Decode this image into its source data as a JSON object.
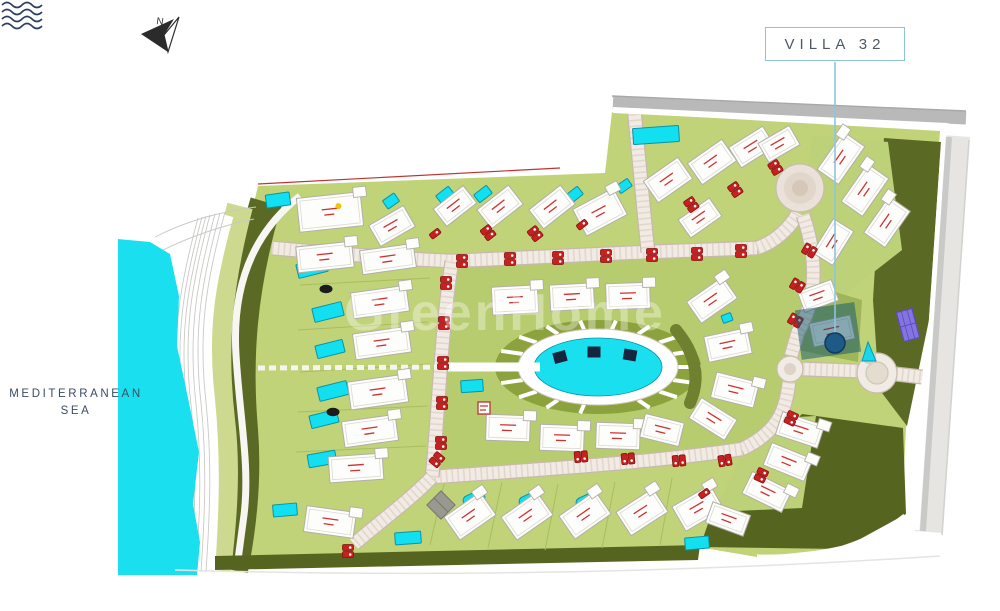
{
  "compass": {
    "label": "N"
  },
  "callout": {
    "label": "VILLA 32"
  },
  "sea": {
    "name_line1": "MEDITERRANEAN",
    "name_line2": "SEA",
    "icon": "waves-icon"
  },
  "watermark": {
    "text": "GreenHome"
  },
  "colors": {
    "sea": "#19dfef",
    "pool": "#12dff0",
    "terrain_light": "#c0d378",
    "terrain_inner": "#b7cc6e",
    "terrain_mid": "#8ba23d",
    "terrain_dark": "#5a6a24",
    "band_green": "#cdd98f",
    "road_surface": "#f1ebe5",
    "road_casing": "#c7b9ab",
    "road_hatch": "#e3d2c8",
    "road_gray": "#b9b9b9",
    "road_right": "#e6e5e2",
    "building_fill": "#fdfdfc",
    "building_stroke": "#b2afa8",
    "accent_red": "#c82020",
    "callout_blue": "#8ec2db",
    "callout_line": "#90c4dc",
    "marker_blue": "#1d5a86",
    "highlight_teal": "rgba(16,84,104,0.5)",
    "court_purple": "#8374e0",
    "platform_navy": "#16243e"
  },
  "map": {
    "roads": [
      "M272,248 C340,254 400,259 452,261 C520,258 600,254 648,252 C700,250 730,249 757,248",
      "M757,248 C775,242 790,228 798,213",
      "M803,215 C818,258 817,300 798,332 L791,356",
      "M789,382 C786,410 778,432 742,449",
      "M742,449 C650,463 520,471 432,477",
      "M432,477 C438,420 441,330 452,261",
      "M432,477 C410,500 382,520 354,544",
      "M634,108 C639,160 643,205 648,252",
      "M803,369 L857,371",
      "M896,374 L922,377"
    ],
    "roundabouts": [
      {
        "cx": 800,
        "cy": 188,
        "rings": [
          [
            24,
            "#eae2d8",
            "#c9bcae"
          ],
          [
            16,
            "#e0d6c9",
            "none"
          ],
          [
            8,
            "#d5c8b8",
            "none"
          ]
        ]
      },
      {
        "cx": 790,
        "cy": 369,
        "rings": [
          [
            13,
            "#f1ebe5",
            "#c9bcae"
          ],
          [
            6,
            "#ddd4c7",
            "none"
          ]
        ]
      },
      {
        "cx": 877,
        "cy": 373,
        "rings": [
          [
            20,
            "#f1ebe5",
            "#c9bcae"
          ],
          [
            11,
            "#e4dccf",
            "#d0c6b8"
          ]
        ]
      }
    ],
    "lagoon": {
      "cx": 598,
      "cy": 367,
      "deck_rx": 80,
      "deck_ry": 38,
      "ring_rx": 103,
      "ring_ry": 47,
      "pier_angles": [
        100,
        120,
        140,
        160,
        180,
        200,
        220,
        240,
        260,
        280,
        300,
        320,
        340,
        0,
        20,
        40,
        60
      ]
    },
    "platforms": [
      [
        560,
        357,
        -15
      ],
      [
        594,
        352,
        0
      ],
      [
        630,
        355,
        10
      ]
    ],
    "villas": [
      [
        455,
        206,
        38,
        22,
        -38,
        0
      ],
      [
        500,
        207,
        40,
        24,
        -38,
        0
      ],
      [
        552,
        207,
        40,
        24,
        -38,
        0
      ],
      [
        600,
        212,
        46,
        30,
        -28,
        0
      ],
      [
        330,
        212,
        64,
        34,
        -6,
        1
      ],
      [
        325,
        257,
        56,
        26,
        -6,
        0
      ],
      [
        392,
        226,
        40,
        24,
        -30,
        0
      ],
      [
        668,
        180,
        42,
        26,
        -35,
        0
      ],
      [
        712,
        162,
        42,
        26,
        -35,
        0
      ],
      [
        752,
        147,
        40,
        24,
        -32,
        0
      ],
      [
        700,
        218,
        38,
        22,
        -35,
        0
      ],
      [
        779,
        144,
        36,
        22,
        -30,
        0
      ],
      [
        841,
        158,
        46,
        26,
        -55,
        0
      ],
      [
        865,
        190,
        46,
        26,
        -55,
        0
      ],
      [
        887,
        222,
        44,
        26,
        -55,
        0
      ],
      [
        833,
        242,
        40,
        24,
        -58,
        0
      ],
      [
        818,
        296,
        36,
        22,
        -20,
        0
      ],
      [
        832,
        331,
        42,
        24,
        -12,
        0
      ],
      [
        712,
        300,
        44,
        26,
        -35,
        0
      ],
      [
        728,
        345,
        44,
        26,
        -12,
        0
      ],
      [
        735,
        390,
        44,
        26,
        14,
        0
      ],
      [
        713,
        419,
        42,
        24,
        32,
        0
      ],
      [
        515,
        300,
        46,
        28,
        -3,
        0
      ],
      [
        572,
        297,
        44,
        26,
        -3,
        0
      ],
      [
        628,
        296,
        44,
        26,
        -2,
        0
      ],
      [
        508,
        428,
        44,
        26,
        2,
        0
      ],
      [
        562,
        438,
        44,
        26,
        2,
        0
      ],
      [
        618,
        436,
        44,
        26,
        2,
        0
      ],
      [
        662,
        430,
        40,
        24,
        14,
        0
      ],
      [
        388,
        259,
        54,
        24,
        -8,
        0
      ],
      [
        380,
        302,
        56,
        26,
        -8,
        0
      ],
      [
        382,
        343,
        56,
        26,
        -8,
        0
      ],
      [
        378,
        392,
        58,
        28,
        -8,
        0
      ],
      [
        370,
        431,
        54,
        26,
        -8,
        0
      ],
      [
        356,
        468,
        54,
        26,
        -4,
        0
      ],
      [
        330,
        522,
        50,
        26,
        8,
        0
      ],
      [
        470,
        516,
        44,
        28,
        -35,
        0
      ],
      [
        527,
        516,
        44,
        28,
        -35,
        0
      ],
      [
        585,
        515,
        44,
        28,
        -35,
        0
      ],
      [
        642,
        512,
        44,
        28,
        -33,
        0
      ],
      [
        698,
        508,
        44,
        28,
        -30,
        0
      ],
      [
        800,
        430,
        44,
        24,
        18,
        0
      ],
      [
        788,
        462,
        44,
        24,
        22,
        0
      ],
      [
        767,
        492,
        44,
        24,
        26,
        0
      ],
      [
        728,
        519,
        40,
        22,
        20,
        0
      ]
    ],
    "pools": [
      [
        445,
        195,
        16,
        10,
        -38,
        1
      ],
      [
        483,
        194,
        16,
        10,
        -38,
        1
      ],
      [
        574,
        195,
        16,
        10,
        -38,
        1
      ],
      [
        624,
        186,
        14,
        9,
        -35,
        1
      ],
      [
        278,
        200,
        24,
        13,
        -8,
        1
      ],
      [
        391,
        201,
        14,
        10,
        -35,
        1
      ],
      [
        656,
        135,
        46,
        16,
        -4,
        1
      ],
      [
        312,
        268,
        30,
        14,
        -14,
        1
      ],
      [
        328,
        312,
        30,
        14,
        -14,
        1
      ],
      [
        330,
        349,
        28,
        13,
        -14,
        1
      ],
      [
        333,
        391,
        30,
        14,
        -14,
        1
      ],
      [
        324,
        419,
        28,
        13,
        -14,
        1
      ],
      [
        322,
        459,
        28,
        13,
        -10,
        1
      ],
      [
        285,
        510,
        24,
        12,
        -5,
        1
      ],
      [
        408,
        538,
        26,
        12,
        -4,
        1
      ],
      [
        472,
        386,
        22,
        12,
        -4,
        1
      ],
      [
        474,
        499,
        22,
        12,
        -25,
        5
      ],
      [
        530,
        500,
        22,
        12,
        -25,
        5
      ],
      [
        587,
        501,
        22,
        12,
        -25,
        5
      ],
      [
        643,
        504,
        22,
        12,
        -25,
        5
      ],
      [
        697,
        543,
        24,
        12,
        -5,
        1
      ],
      [
        727,
        318,
        10,
        8,
        -20,
        1
      ]
    ],
    "cars": [
      [
        462,
        264,
        0,
        2
      ],
      [
        510,
        262,
        0,
        2
      ],
      [
        558,
        261,
        0,
        2
      ],
      [
        606,
        259,
        0,
        2
      ],
      [
        652,
        258,
        0,
        2
      ],
      [
        697,
        257,
        0,
        2
      ],
      [
        741,
        254,
        0,
        2
      ],
      [
        437,
        236,
        -38,
        1
      ],
      [
        490,
        235,
        -38,
        2
      ],
      [
        537,
        236,
        -38,
        2
      ],
      [
        584,
        227,
        -38,
        1
      ],
      [
        693,
        207,
        -35,
        2
      ],
      [
        737,
        192,
        -35,
        2
      ],
      [
        777,
        170,
        -32,
        2
      ],
      [
        812,
        252,
        -60,
        2
      ],
      [
        800,
        287,
        -60,
        2
      ],
      [
        798,
        322,
        -60,
        2
      ],
      [
        446,
        286,
        0,
        2
      ],
      [
        444,
        326,
        0,
        2
      ],
      [
        443,
        366,
        0,
        2
      ],
      [
        442,
        406,
        0,
        2
      ],
      [
        441,
        446,
        0,
        2
      ],
      [
        578,
        457,
        85,
        2
      ],
      [
        625,
        459,
        85,
        2
      ],
      [
        676,
        461,
        85,
        2
      ],
      [
        722,
        461,
        80,
        2
      ],
      [
        435,
        462,
        40,
        2
      ],
      [
        790,
        421,
        25,
        2
      ],
      [
        760,
        478,
        25,
        2
      ],
      [
        706,
        496,
        -35,
        1
      ],
      [
        348,
        554,
        0,
        2
      ]
    ],
    "dark_ovals": [
      [
        326,
        289
      ],
      [
        333,
        412
      ]
    ],
    "plot_lines": [
      "M445,480L430,545",
      "M502,482L488,548",
      "M558,484L545,550",
      "M615,482L602,548",
      "M672,478L660,545",
      "M300,285L430,278",
      "M298,330L428,322",
      "M300,372L430,364",
      "M298,412L428,406",
      "M296,452L426,446"
    ]
  }
}
